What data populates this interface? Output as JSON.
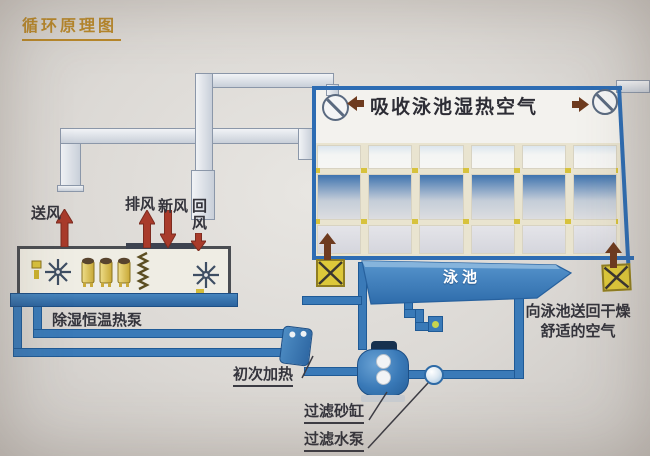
{
  "title": "循环原理图",
  "unit": {
    "name_label": "除湿恒温热泵",
    "supply_air": "送风",
    "exhaust_air": "排风",
    "fresh_air": "新风",
    "return_air": "回风"
  },
  "hall": {
    "absorb_label": "吸收泳池湿热空气",
    "pool_label": "泳池",
    "return_note_line1": "向泳池送回干燥",
    "return_note_line2": "舒适的空气"
  },
  "water_loop": {
    "primary_heater": "初次加热",
    "sand_filter": "过滤砂缸",
    "filter_pump": "过滤水泵"
  },
  "colors": {
    "pipe_blue": "#3a7ab8",
    "pipe_edge": "#1f5a96",
    "frame_blue": "#2d6cb3",
    "duct_edge": "#8b97a9",
    "arrow_red": "#a93b2b",
    "arrow_red_edge": "#7c2b1f",
    "arrow_brown": "#6e3b1f",
    "joint_yellow": "#d7c23c",
    "compressor_yellow": "#d9c23e",
    "pool_blue": "#3f7fc0",
    "title_gold": "#b8882b",
    "label_dark": "#34343c"
  }
}
